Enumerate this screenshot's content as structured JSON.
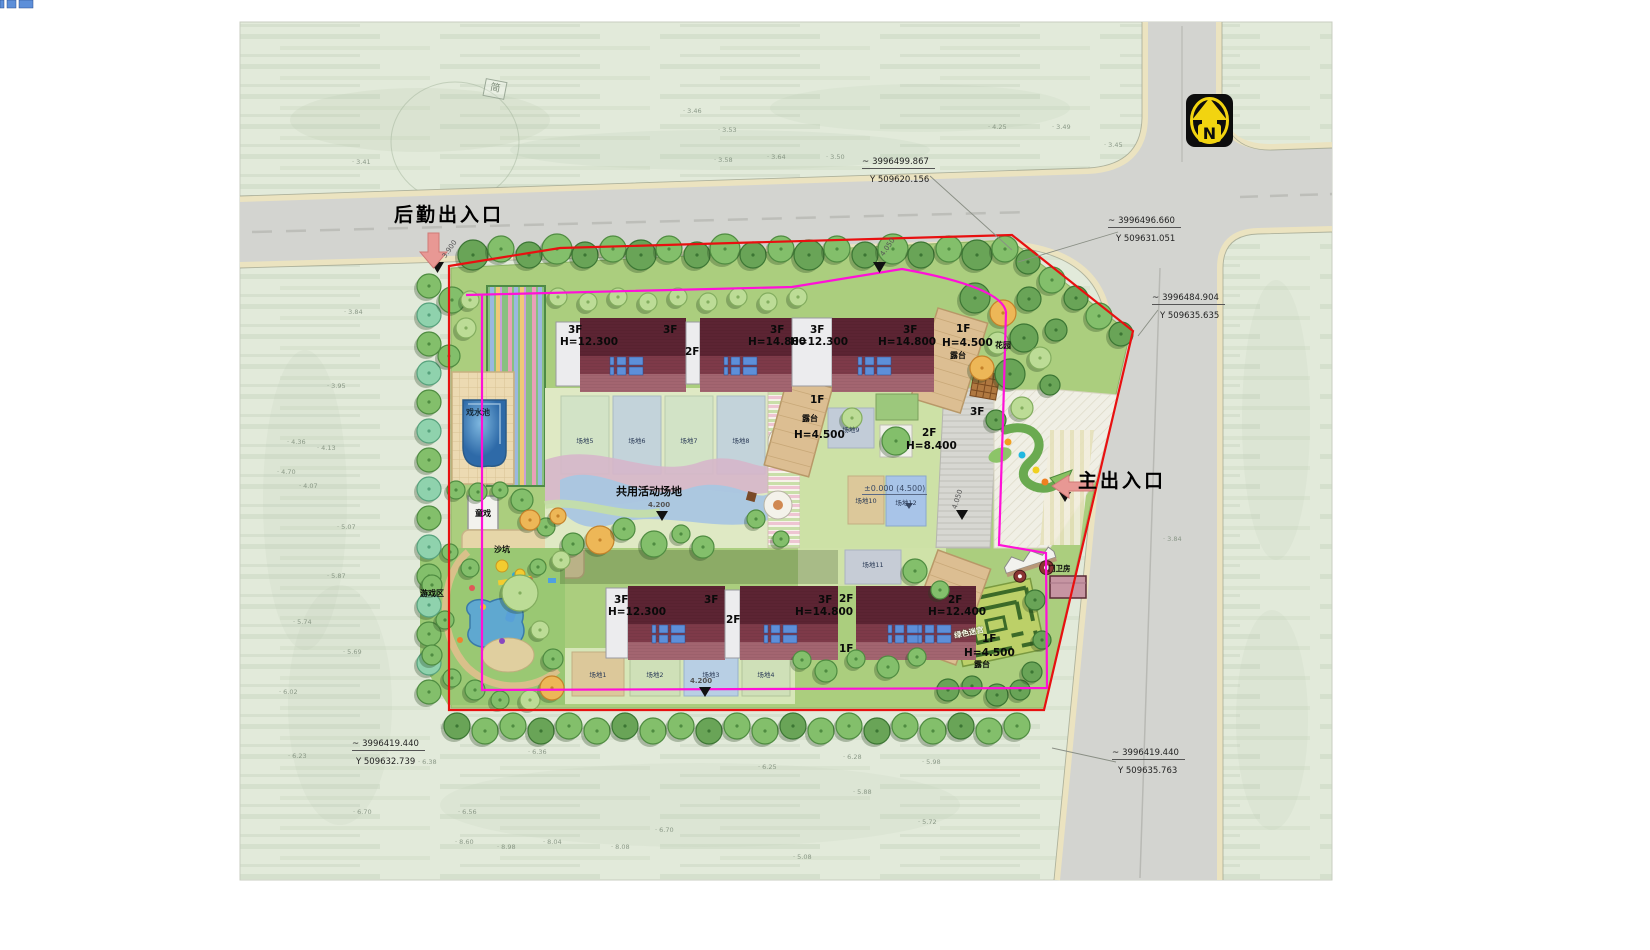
{
  "north": "N",
  "icons": {
    "squiggle": "~"
  },
  "entrances": {
    "service": "后勤出入口",
    "main": "主出入口"
  },
  "survey": {
    "p1": {
      "n": "3996499.867",
      "e": "Y 509620.156"
    },
    "p2": {
      "n": "3996496.660",
      "e": "Y 509631.051"
    },
    "p3": {
      "n": "3996484.904",
      "e": "Y 509635.635"
    },
    "p4": {
      "n": "3996419.440",
      "e": "Y 509632.739"
    },
    "p5": {
      "n": "3996419.440",
      "e": "Y 509635.763"
    }
  },
  "buildings": {
    "t1_floor": "3F",
    "t1_h": "H=12.300",
    "t1_floor_r": "3F",
    "link1": "2F",
    "t2_floor": "3F",
    "t2_h": "H=14.800",
    "t3_floor": "3F",
    "t3_h": "H=12.300",
    "t4_floor": "3F",
    "t4_h": "H=14.800",
    "ter1_floor": "1F",
    "ter1_h": "H=4.500",
    "ter1_name": "露台",
    "wing": "3F",
    "ter2_floor": "1F",
    "ter2_name": "露台",
    "ter2_h": "H=4.500",
    "mid_floor": "2F",
    "mid_h": "H=8.400",
    "b1_floor": "3F",
    "b1_h": "H=12.300",
    "b1_floor_r": "3F",
    "link2": "2F",
    "b2_floor": "3F",
    "b2_h": "H=14.800",
    "gap_floor": "2F",
    "gap_1f": "1F",
    "b3_floor": "2F",
    "b3_h": "H=12.400",
    "ter3_floor": "1F",
    "ter3_h": "H=4.500",
    "ter3_name": "露台"
  },
  "places": {
    "pool": "戏水池",
    "kids_play": "童戏",
    "sand": "沙坑",
    "play_zone": "游戏区",
    "shared_field": "共用活动场地",
    "garden": "花园",
    "maze": "绿色迷宫",
    "guard": "门卫房",
    "sheet_tag": "简"
  },
  "levels": {
    "zero": "±0.000 (4.500)",
    "shared": "4.200",
    "south": "4.200",
    "road_main": "4.050",
    "road_top1": "3.900",
    "road_top2": "4.050"
  },
  "pads": [
    "场地1",
    "场地2",
    "场地3",
    "场地4",
    "场地5",
    "场地6",
    "场地7",
    "场地8",
    "场地9",
    "场地10",
    "场地11",
    "场地12"
  ],
  "spots": [
    {
      "x": 683,
      "y": 107,
      "v": "3.46"
    },
    {
      "x": 718,
      "y": 126,
      "v": "3.53"
    },
    {
      "x": 767,
      "y": 153,
      "v": "3.64"
    },
    {
      "x": 714,
      "y": 156,
      "v": "3.58"
    },
    {
      "x": 826,
      "y": 153,
      "v": "3.50"
    },
    {
      "x": 988,
      "y": 123,
      "v": "4.25"
    },
    {
      "x": 1052,
      "y": 123,
      "v": "3.49"
    },
    {
      "x": 1104,
      "y": 141,
      "v": "3.45"
    },
    {
      "x": 352,
      "y": 158,
      "v": "3.41"
    },
    {
      "x": 344,
      "y": 308,
      "v": "3.84"
    },
    {
      "x": 327,
      "y": 382,
      "v": "3.95"
    },
    {
      "x": 287,
      "y": 438,
      "v": "4.36"
    },
    {
      "x": 317,
      "y": 444,
      "v": "4.13"
    },
    {
      "x": 277,
      "y": 468,
      "v": "4.70"
    },
    {
      "x": 299,
      "y": 482,
      "v": "4.07"
    },
    {
      "x": 337,
      "y": 523,
      "v": "5.07"
    },
    {
      "x": 327,
      "y": 572,
      "v": "5.87"
    },
    {
      "x": 293,
      "y": 618,
      "v": "5.74"
    },
    {
      "x": 343,
      "y": 648,
      "v": "5.69"
    },
    {
      "x": 279,
      "y": 688,
      "v": "6.02"
    },
    {
      "x": 288,
      "y": 752,
      "v": "6.23"
    },
    {
      "x": 418,
      "y": 758,
      "v": "6.38"
    },
    {
      "x": 528,
      "y": 748,
      "v": "6.36"
    },
    {
      "x": 458,
      "y": 808,
      "v": "6.56"
    },
    {
      "x": 353,
      "y": 808,
      "v": "6.70"
    },
    {
      "x": 543,
      "y": 838,
      "v": "8.04"
    },
    {
      "x": 497,
      "y": 843,
      "v": "8.98"
    },
    {
      "x": 455,
      "y": 838,
      "v": "8.60"
    },
    {
      "x": 611,
      "y": 843,
      "v": "8.08"
    },
    {
      "x": 655,
      "y": 826,
      "v": "6.70"
    },
    {
      "x": 758,
      "y": 763,
      "v": "6.25"
    },
    {
      "x": 843,
      "y": 753,
      "v": "6.28"
    },
    {
      "x": 853,
      "y": 788,
      "v": "5.88"
    },
    {
      "x": 922,
      "y": 758,
      "v": "5.98"
    },
    {
      "x": 918,
      "y": 818,
      "v": "5.72"
    },
    {
      "x": 793,
      "y": 853,
      "v": "5.08"
    },
    {
      "x": 1163,
      "y": 535,
      "v": "3.84"
    }
  ]
}
